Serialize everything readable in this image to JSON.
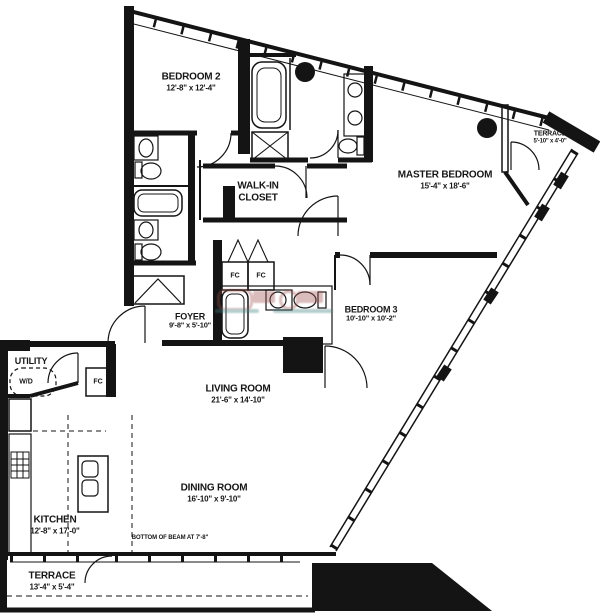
{
  "plan_title": "apartment-floor-plan",
  "rooms": {
    "bedroom2": {
      "name": "BEDROOM 2",
      "dims": "12'-8\" x 12'-4\""
    },
    "walk_in_closet": {
      "line1": "WALK-IN",
      "line2": "CLOSET"
    },
    "master_bedroom": {
      "name": "MASTER BEDROOM",
      "dims": "15'-4\" x 18'-6\""
    },
    "terrace_top": {
      "name": "TERRACE",
      "dims": "5'-10\" x 4'-0\""
    },
    "foyer": {
      "name": "FOYER",
      "dims": "9'-8\" x 5'-10\""
    },
    "bedroom3": {
      "name": "BEDROOM 3",
      "dims": "10'-10\" x 10'-2\""
    },
    "utility": {
      "name": "UTILITY"
    },
    "living_room": {
      "name": "LIVING ROOM",
      "dims": "21'-6\" x 14'-10\""
    },
    "dining_room": {
      "name": "DINING ROOM",
      "dims": "16'-10\" x 9'-10\""
    },
    "kitchen": {
      "name": "KITCHEN",
      "dims": "12'-8\" x 17'-0\""
    },
    "terrace_bottom": {
      "name": "TERRACE",
      "dims": "13'-4\" x 5'-4\""
    }
  },
  "labels": {
    "washer_dryer": "W/D",
    "closet_fc_utility": "FC",
    "closet_fc_left": "FC",
    "closet_fc_right": "FC",
    "beam_note": "BOTTOM OF BEAM AT 7'-8\""
  },
  "colors": {
    "walls": "#141414",
    "background": "#ffffff",
    "watermark_red": "#a05252",
    "watermark_teal": "#45807f"
  }
}
